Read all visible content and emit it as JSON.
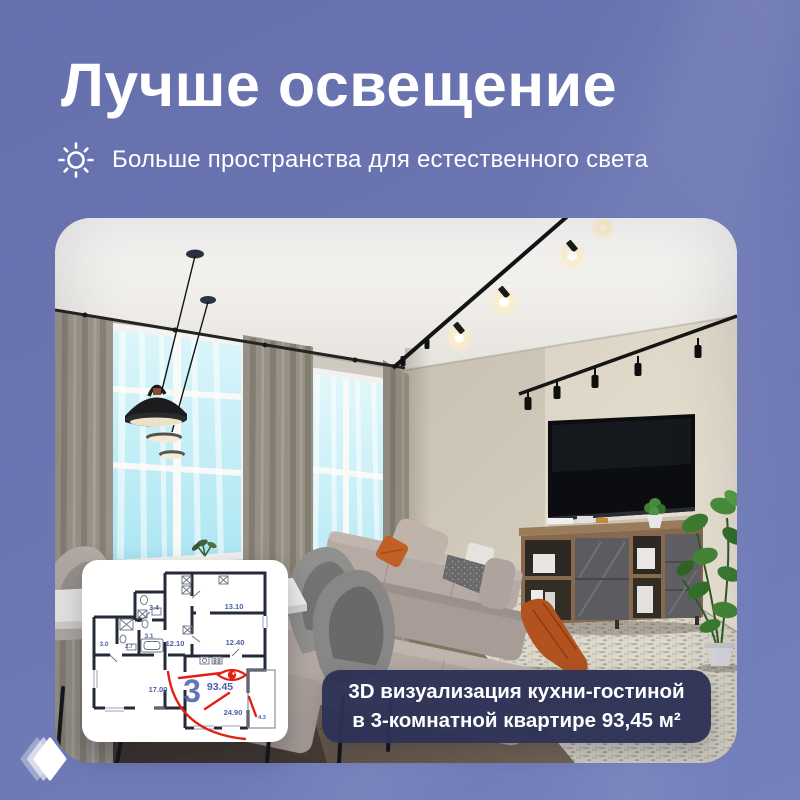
{
  "header": {
    "title": "Лучше освещение",
    "subtitle": "Больше пространства для естественного света"
  },
  "badge": {
    "line1": "3D визуализация кухни-гостиной",
    "line2": "в 3-комнатной квартире 93,45 м²"
  },
  "floorplan": {
    "apartment_number": "3",
    "total_area": "93.45",
    "areas": [
      "3.4",
      "13.10",
      "12.40",
      "3.0",
      "2.7",
      "3.1",
      "12.10",
      "17.00",
      "24.90",
      "4.3"
    ]
  },
  "colors": {
    "background": "#6a75b2",
    "badge_bg": "#2d3357",
    "plan_number_blue": "#4a5da8",
    "annotation_red": "#e22015"
  }
}
